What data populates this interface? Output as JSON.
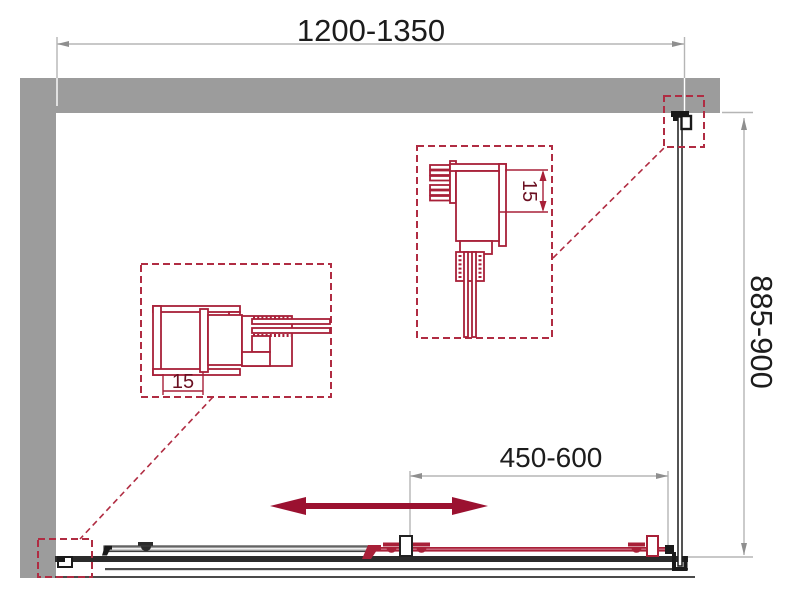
{
  "page": {
    "description": "Technical plan drawing of a corner shower enclosure with one sliding door",
    "background": "#ffffff"
  },
  "dimensions": {
    "width": {
      "label": "1200-1350"
    },
    "depth": {
      "label": "885-900"
    },
    "door_travel": {
      "label": "450-600"
    }
  },
  "details": {
    "left_profile": {
      "adjustment": "15"
    },
    "top_profile": {
      "adjustment": "15"
    }
  },
  "colors": {
    "wall_gray": "#9C9C9C",
    "profile_red": "#A82038",
    "dashed_red": "#B02C42",
    "arrow_red": "#9B1130",
    "dimension_line_gray": "#B5B5B5",
    "ink_black": "#1C1C1C"
  }
}
